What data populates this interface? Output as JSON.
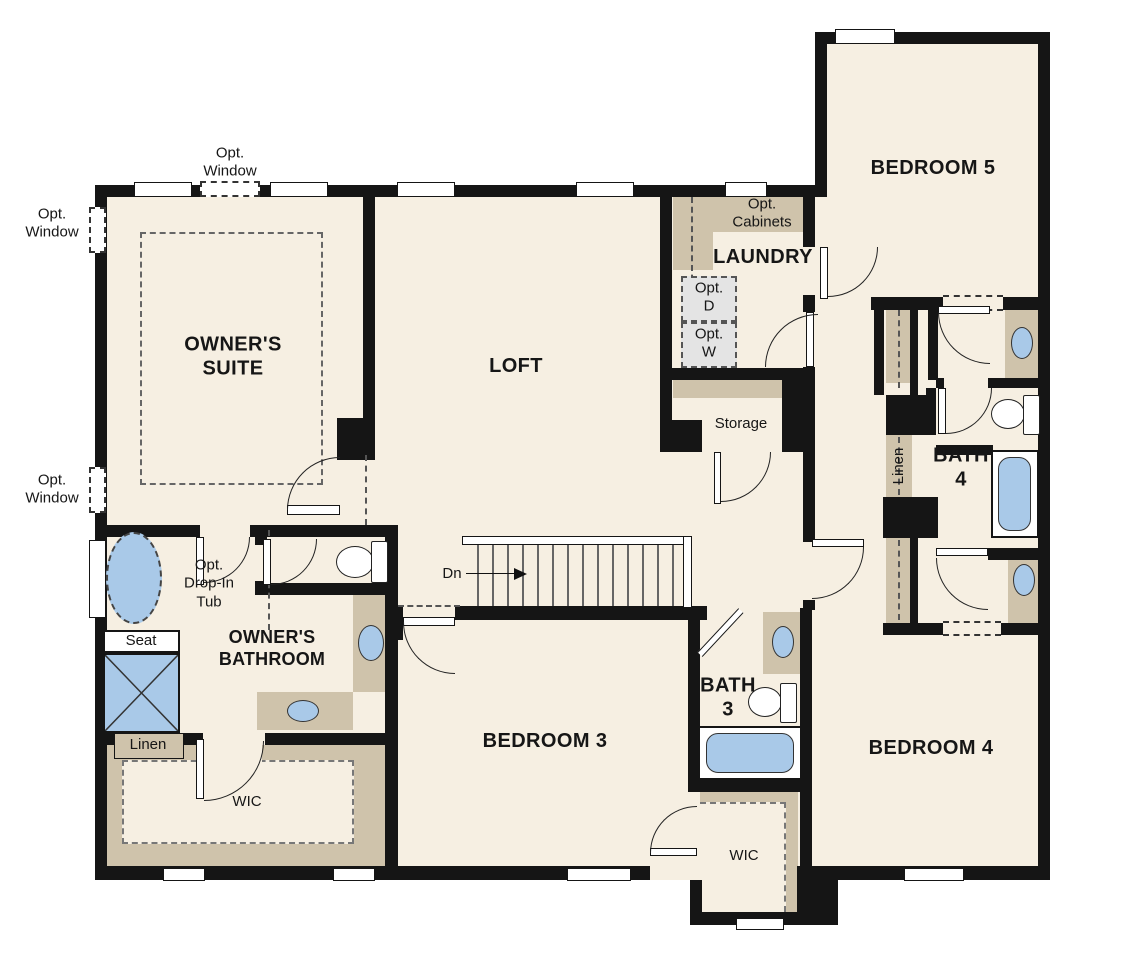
{
  "title": "Second Floor Plan",
  "colors": {
    "wall": "#151515",
    "floor": "#f6efe2",
    "cabinet_tan": "#cfc3ab",
    "fixture_blue": "#a9c9e8",
    "optional_gray": "#e4e4e4",
    "background": "#ffffff"
  },
  "rooms": {
    "owners_suite": "OWNER'S\nSUITE",
    "loft": "LOFT",
    "laundry": "LAUNDRY",
    "bedroom5": "BEDROOM 5",
    "bath4": "BATH\n4",
    "bedroom4": "BEDROOM 4",
    "bedroom3": "BEDROOM 3",
    "bath3": "BATH\n3",
    "owners_bathroom": "OWNER'S\nBATHROOM",
    "storage": "Storage",
    "wic_owner": "WIC",
    "wic_bedroom3": "WIC",
    "linen_owner": "Linen",
    "linen_hall": "Linen",
    "seat": "Seat"
  },
  "annotations": {
    "opt_window": "Opt.\nWindow",
    "opt_cabinets": "Opt.\nCabinets",
    "opt_dryer": "Opt.\nD",
    "opt_washer": "Opt.\nW",
    "opt_drop_in_tub": "Opt.\nDrop-In\nTub",
    "down": "Dn"
  }
}
